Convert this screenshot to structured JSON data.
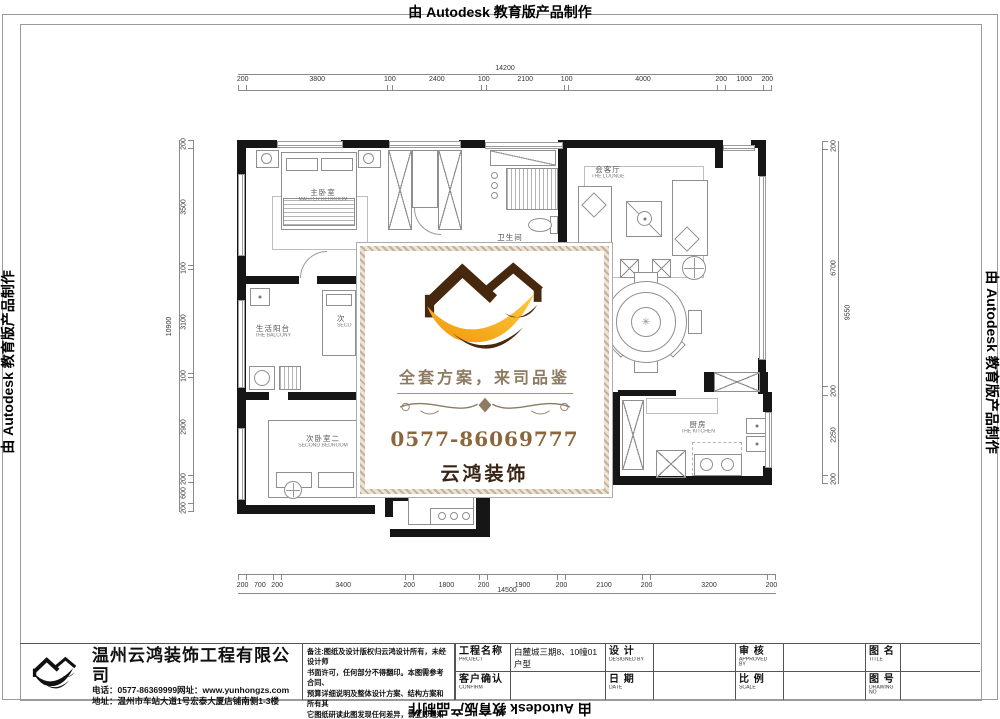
{
  "edge": {
    "top": "由 Autodesk 教育版产品制作",
    "bottom": "由 Autodesk 教育版产品制作",
    "left": "由 Autodesk 教育版产品制作",
    "right": "由 Autodesk 教育版产品制作"
  },
  "plan": {
    "dims": {
      "top": {
        "total": "14200",
        "segments": [
          "200",
          "3800",
          "100",
          "2400",
          "100",
          "2100",
          "100",
          "4000",
          "200",
          "1000",
          "200"
        ]
      },
      "bottom": {
        "total": "14500",
        "segments": [
          "200",
          "700",
          "200",
          "3400",
          "200",
          "1800",
          "200",
          "1900",
          "200",
          "2100",
          "200",
          "3200",
          "200"
        ]
      },
      "left": {
        "total": "10900",
        "segments": [
          "200",
          "3500",
          "100",
          "3100",
          "100",
          "2900",
          "200",
          "600",
          "200"
        ]
      },
      "right": {
        "total": "9550",
        "segments": [
          "200",
          "6700",
          "200",
          "2250",
          "200"
        ]
      }
    },
    "rooms": [
      {
        "zh": "主卧室",
        "en": "MASTER BEDROOM"
      },
      {
        "zh": "会客厅",
        "en": "THE LOUNGE"
      },
      {
        "zh": "卫生间",
        "en": ""
      },
      {
        "zh": "生活阳台",
        "en": "THE BALCONY"
      },
      {
        "zh": "次卧室二",
        "en": "SECOND BEDROOM"
      },
      {
        "zh": "厨房",
        "en": "THE KITCHEN"
      },
      {
        "zh": "次",
        "en": "SECO"
      }
    ]
  },
  "card": {
    "slogan": "全套方案，来司品鉴",
    "phone": "0577-86069777",
    "brand": "云鸿装饰",
    "colors": {
      "roof_brown": "#46280e",
      "swoosh_orange": "#f7a823",
      "phone_brown": "#8a673c"
    }
  },
  "titleblock": {
    "company": "温州云鸿装饰工程有限公司",
    "phone_line": "电话：0577-86369999网址：www.yunhongzs.com",
    "address_line": "地址：温州市车站大道1号宏泰大厦店铺南侧1-3楼",
    "remarks": "备注:图纸及设计版权归云鸿设计所有，未经设计师\n书面许可，任何部分不得翻印。本图需参考合同、\n预算详细说明及整体设计方案、结构方案和所有其\n它图纸研读此图发现任何差异，请立即通知设计师。",
    "fields": [
      {
        "label": "工程名称",
        "sub": "PROJECT",
        "value": "白麓城三期8、10幢01户型"
      },
      {
        "label": "设  计",
        "sub": "DESIGNED BY",
        "value": ""
      },
      {
        "label": "审  核",
        "sub": "APPROVED BY",
        "value": ""
      },
      {
        "label": "图  名",
        "sub": "TITLE",
        "value": ""
      },
      {
        "label": "客户确认",
        "sub": "CONFIRM",
        "value": ""
      },
      {
        "label": "日  期",
        "sub": "DATE",
        "value": ""
      },
      {
        "label": "比  例",
        "sub": "SCALE",
        "value": ""
      },
      {
        "label": "图  号",
        "sub": "DRAWING NO",
        "value": ""
      }
    ]
  }
}
